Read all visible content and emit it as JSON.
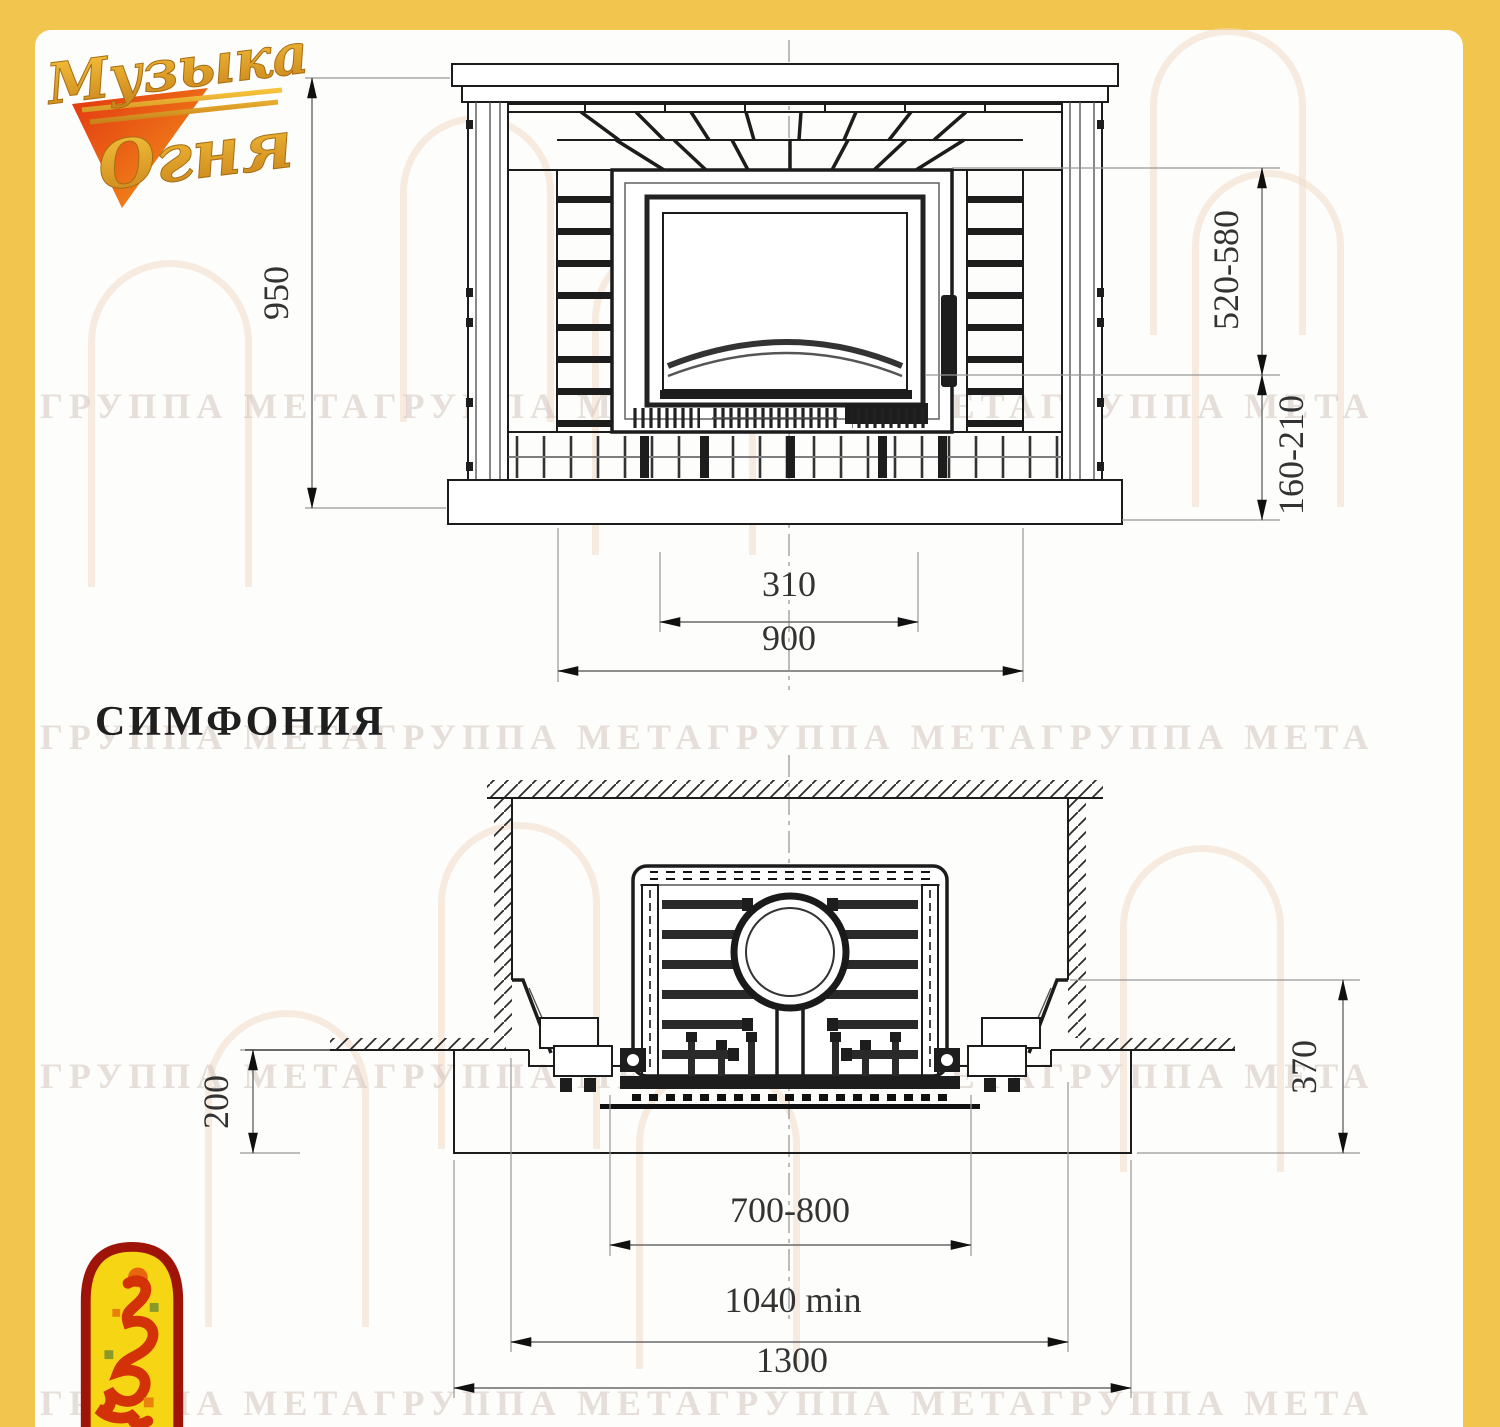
{
  "page": {
    "title_label": "СИМФОНИЯ"
  },
  "logo": {
    "line1": "Музыка",
    "line2": "Огня"
  },
  "watermark": {
    "text": "ГРУППА МЕТАГРУППА МЕТАГРУППА МЕТАГРУППА МЕТА"
  },
  "colors": {
    "frame_yellow": "#f2c64e",
    "paper": "#fdfdfb",
    "line_dark": "#1c1c1c",
    "emblem_red": "#9e1408",
    "emblem_yellow": "#f6d514"
  },
  "front_view": {
    "label": "fireplace-front-elevation",
    "dimensions": {
      "height": "950",
      "firebox_top": "520-580",
      "firebox_bottom": "160-210",
      "opening_width": "310",
      "width": "900"
    }
  },
  "plan_view": {
    "label": "fireplace-plan-section",
    "dimensions": {
      "hearth_depth": "200",
      "wall_offset": "370",
      "insert_width": "700-800",
      "niche_width": "1040 min",
      "base_width": "1300"
    }
  }
}
